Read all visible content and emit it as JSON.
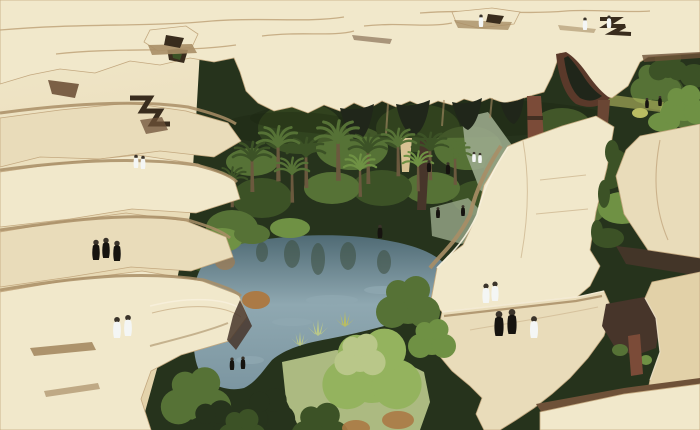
{
  "image": {
    "kind": "architectural-concept-rendering",
    "subject": "Aerial view of a desert oasis park: cracked sand-coloured canopy plates raised on arched columns shading palm groves and a central pond, with small white- and black-robed figures walking on the plates",
    "inventory": {
      "canopy_plates": 9,
      "arched_openings": 5,
      "columns": 5,
      "palm_trees": 12,
      "round_trees": 10,
      "ponds": 1,
      "figures_white_robed": 12,
      "figures_black_robed": 14
    },
    "palette": {
      "sand_light": "#f1e8cb",
      "sand": "#e9dcba",
      "sand_warm": "#e2d1a8",
      "sand_dim": "#d8c293",
      "edge_line": "#c3a87f",
      "lip_light": "#f7f0dc",
      "shadow_tan": "#a98e66",
      "shadow_brown": "#6e5138",
      "shadow_deep": "#47352a",
      "crack_dark": "#392c1d",
      "arch_void": "#20261a",
      "arch_red": "#5a392a",
      "column_red": "#7b4b38",
      "column_brown": "#6a4634",
      "column_dark": "#3a2a1f",
      "trunk": "#6b593e",
      "green_dark": "#26331c",
      "green_deep": "#3c5226",
      "green_mid": "#567236",
      "green_bright": "#6f9144",
      "green_light": "#94b35e",
      "green_pale": "#b9c789",
      "lawn": "#b3c287",
      "accent_yellow": "#b9bd62",
      "water_dark": "#4f6a74",
      "water_mid": "#7c96a1",
      "water_light": "#8fa8b1",
      "reflection": "#3f5244",
      "path_grey": "#9aa98b",
      "figure_white": "#f4f6f5",
      "figure_head": "#3a332a",
      "figure_black": "#16130f",
      "shrub_orange": "#ab7a45",
      "canopy_shade": "#1c2412"
    }
  }
}
